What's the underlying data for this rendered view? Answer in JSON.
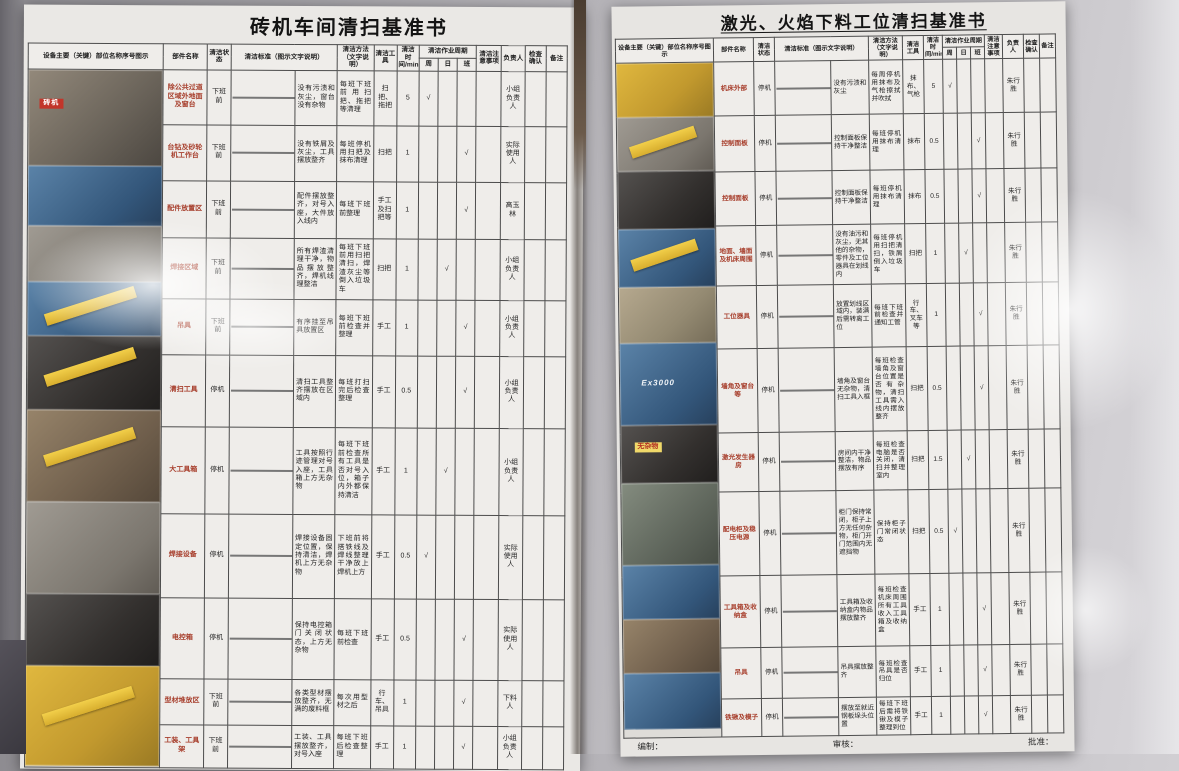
{
  "headers": {
    "photo_col": "设备主要（关键）部位名称序号图示",
    "part": "部件名称",
    "state": "清洁状态",
    "standard": "清洁标准（图示文字说明）",
    "method": "清洁方法（文字说明）",
    "tool": "清洁工具",
    "time": "清洁时间/min",
    "period": "清洁作业周期",
    "period_sub": [
      "周",
      "日",
      "班"
    ],
    "note": "清洁注意事项",
    "person": "负责人",
    "check": "检查确认",
    "remark": "备注",
    "check_mark": "√"
  },
  "left_doc": {
    "title": "砖机车间清扫基准书",
    "rows": [
      {
        "part": "除公共过道区域外地面及窗台",
        "state": "下班前",
        "standard": "没有污渍和灰尘，窗台没有杂物",
        "method": "每班下班前用扫把、拖把等清理",
        "tool": "扫把、拖把",
        "time": "5",
        "period": "周",
        "note": "",
        "person": "小组负责人",
        "check": "",
        "remark": "",
        "tone": "gray"
      },
      {
        "part": "台钻及砂轮机工作台",
        "state": "下班前",
        "standard": "没有铁屑及灰尘，工具摆放整齐",
        "method": "每班停机用扫把及抹布清理",
        "tool": "扫把",
        "time": "1",
        "period": "班",
        "note": "",
        "person": "实际使用人",
        "check": "",
        "remark": "",
        "tone": "machblue"
      },
      {
        "part": "配件放置区",
        "state": "下班前",
        "standard": "配件摆放整齐，对号入座，大件放入线内",
        "method": "每班下班前整理",
        "tool": "手工及扫把等",
        "time": "1",
        "period": "班",
        "note": "",
        "person": "高玉林",
        "check": "",
        "remark": "",
        "tone": "racks"
      },
      {
        "part": "焊接区域",
        "state": "下班前",
        "standard": "所有焊渣清理干净，物品摆放整齐，焊机线理整洁",
        "method": "每班下班前用扫把清扫，焊渣灰尘等倒入垃圾车",
        "tool": "扫把",
        "time": "1",
        "period": "日",
        "note": "",
        "person": "小组负责人",
        "check": "",
        "remark": "",
        "tone": "dark"
      },
      {
        "part": "吊具",
        "state": "下班前",
        "standard": "有序挂至吊具放置区",
        "method": "每班下班前检查并整理",
        "tool": "手工",
        "time": "1",
        "period": "班",
        "note": "",
        "person": "小组负责人",
        "check": "",
        "remark": "",
        "tone": "dark"
      },
      {
        "part": "清扫工具",
        "state": "停机",
        "standard": "清扫工具整齐摆放在区域内",
        "method": "每班打扫完后检查整理",
        "tool": "手工",
        "time": "0.5",
        "period": "班",
        "note": "",
        "person": "小组负责人",
        "check": "",
        "remark": "",
        "tone": "dark"
      },
      {
        "part": "大工具箱",
        "state": "停机",
        "standard": "工具按照行迹管理对号入座，工具箱上方无杂物",
        "method": "每班下班前检查所有工具是否对号入位，箱子内外都保持清洁",
        "tool": "手工",
        "time": "1",
        "period": "日",
        "note": "",
        "person": "小组负责人",
        "check": "",
        "remark": "",
        "tone": "yellow"
      },
      {
        "part": "焊接设备",
        "state": "停机",
        "standard": "焊接设备固定位置，保持清洁，焊机上方无杂物",
        "method": "下班前将搭铁线及焊线整理干净放上焊机上方",
        "tool": "手工",
        "time": "0.5",
        "period": "周",
        "note": "",
        "person": "实际使用人",
        "check": "",
        "remark": "",
        "tone": "gray"
      },
      {
        "part": "电控箱",
        "state": "停机",
        "standard": "保持电控箱门关闭状态，上方无杂物",
        "method": "每班下班前检查",
        "tool": "手工",
        "time": "0.5",
        "period": "班",
        "note": "",
        "person": "实际使用人",
        "check": "",
        "remark": "",
        "tone": "door"
      },
      {
        "part": "型材堆放区",
        "state": "下班前",
        "standard": "各类型材摆放整齐，无满的废料框",
        "method": "每次用型材之后",
        "tool": "行车、吊具",
        "time": "1",
        "period": "班",
        "note": "",
        "person": "下料人",
        "check": "",
        "remark": "",
        "tone": "wood"
      },
      {
        "part": "工装、工具架",
        "state": "下班前",
        "standard": "工装、工具摆放整齐，对号入座",
        "method": "每班下班后检查整理",
        "tool": "手工",
        "time": "1",
        "period": "班",
        "note": "",
        "person": "小组负责人",
        "check": "",
        "remark": "",
        "tone": "machblue"
      }
    ],
    "side_photos": [
      {
        "tone": "industrial",
        "tag": "砖机"
      },
      {
        "tone": "machblue"
      },
      {
        "tone": "gray"
      },
      {
        "tone": "machblue",
        "ribbon": true
      },
      {
        "tone": "dark",
        "ribbon": true
      },
      {
        "tone": "racks",
        "ribbon": true
      },
      {
        "tone": "gray"
      },
      {
        "tone": "dark"
      },
      {
        "tone": "yellow",
        "ribbon": true
      }
    ]
  },
  "right_doc": {
    "title": "激光、火焰下料工位清扫基准书",
    "rows": [
      {
        "part": "机床外部",
        "state": "停机",
        "standard": "没有污渍和灰尘",
        "method": "每周停机用抹布及气枪擦拭并吹拭",
        "tool": "抹布、气枪",
        "time": "5",
        "period": "周",
        "note": "",
        "person": "朱行胜",
        "check": "",
        "remark": "",
        "tone": "yellow"
      },
      {
        "part": "控制面板",
        "state": "停机",
        "standard": "控制面板保持干净整洁",
        "method": "每班停机用抹布清理",
        "tool": "抹布",
        "time": "0.5",
        "period": "班",
        "note": "",
        "person": "朱行胜",
        "check": "",
        "remark": "",
        "tone": "dark"
      },
      {
        "part": "控制面板",
        "state": "停机",
        "standard": "控制面板保持干净整洁",
        "method": "每班停机用抹布清理",
        "tool": "抹布",
        "time": "0.5",
        "period": "班",
        "note": "",
        "person": "朱行胜",
        "check": "",
        "remark": "",
        "tone": "dark"
      },
      {
        "part": "地面、墙面及机床周围",
        "state": "停机",
        "standard": "没有油污和灰尘，无其他的杂物，零件及工位器具在划线内",
        "method": "每班停机用扫把清扫，铁屑倒入垃圾车",
        "tool": "扫把",
        "time": "1",
        "period": "日",
        "note": "",
        "person": "朱行胜",
        "check": "",
        "remark": "",
        "tone": "gray"
      },
      {
        "part": "工位器具",
        "state": "停机",
        "standard": "放置划线区域内，装满后需转离工位",
        "method": "每班下班前检查并通知工管",
        "tool": "行车、叉车等",
        "time": "1",
        "period": "班",
        "note": "",
        "person": "朱行胜",
        "check": "",
        "remark": "",
        "tone": "machblue"
      },
      {
        "part": "墙角及窗台等",
        "state": "停机",
        "standard": "墙角及窗台无杂物，清扫工具入框",
        "method": "每班检查墙角及窗台位置是否有杂物，清扫工具需入线内摆放整齐",
        "tool": "扫把",
        "time": "0.5",
        "period": "班",
        "note": "",
        "person": "朱行胜",
        "check": "",
        "remark": "",
        "tone": "corridor"
      },
      {
        "part": "激光发生器房",
        "state": "停机",
        "standard": "房间内干净整洁，物品摆放有序",
        "method": "每班检查电脑是否关闭，清扫并整理室内",
        "tool": "扫把",
        "time": "1.5",
        "period": "日",
        "note": "",
        "person": "朱行胜",
        "check": "",
        "remark": "",
        "tone": "gray"
      },
      {
        "part": "配电柜及稳压电源",
        "state": "停机",
        "standard": "柜门保持常闭，柜子上方无任何杂物，柜门开门范围内无遮挡物",
        "method": "保持柜子门常闭状态",
        "tool": "扫把",
        "time": "0.5",
        "period": "周",
        "note": "",
        "person": "朱行胜",
        "check": "",
        "remark": "",
        "tone": "machblue"
      },
      {
        "part": "工具箱及收纳盒",
        "state": "停机",
        "standard": "工具箱及收纳盒内物品摆放整齐",
        "method": "每班检查机床周围所有工具收入工具箱及收纳盒",
        "tool": "手工",
        "time": "1",
        "period": "班",
        "note": "",
        "person": "朱行胜",
        "check": "",
        "remark": "",
        "tone": "dark"
      },
      {
        "part": "吊具",
        "state": "停机",
        "standard": "吊具摆放整齐",
        "method": "每班检查吊具是否归位",
        "tool": "手工",
        "time": "1",
        "period": "班",
        "note": "",
        "person": "朱行胜",
        "check": "",
        "remark": "",
        "tone": "green"
      },
      {
        "part": "铁锹及模子",
        "state": "停机",
        "standard": "摆放至就近钢板垛头位置",
        "method": "每班下班后需将铁锹及模子整理到位",
        "tool": "手工",
        "time": "1",
        "period": "班",
        "note": "",
        "person": "朱行胜",
        "check": "",
        "remark": "",
        "tone": "yellow"
      }
    ],
    "side_photos": [
      {
        "tone": "yellow"
      },
      {
        "tone": "gray",
        "ribbon": true
      },
      {
        "tone": "dark"
      },
      {
        "tone": "machblue",
        "ribbon": true
      },
      {
        "tone": "corridor"
      },
      {
        "tone": "machblue",
        "label": "Ex3000"
      },
      {
        "tone": "dark",
        "tag": "无杂物"
      },
      {
        "tone": "cyl"
      },
      {
        "tone": "machblue"
      },
      {
        "tone": "racks"
      },
      {
        "tone": "machblue"
      }
    ],
    "footer": {
      "prepared": "编制：",
      "reviewed": "审核：",
      "approved": "批准："
    }
  }
}
